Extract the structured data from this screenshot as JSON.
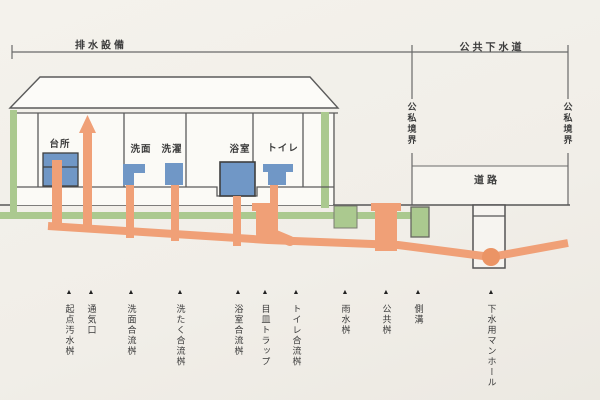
{
  "header": {
    "left_bracket": "排水設備",
    "right_bracket": "公共下水道"
  },
  "boundary_left_label": "公私境界",
  "boundary_right_label": "公私境界",
  "road_label": "道路",
  "rooms": {
    "kitchen": "台所",
    "washbasin": "洗面",
    "laundry": "洗濯",
    "bathroom": "浴室",
    "toilet": "トイレ"
  },
  "marker_glyph": "▲",
  "markers": [
    {
      "label": "起点汚水桝"
    },
    {
      "label": "通気口"
    },
    {
      "label": "洗面合流桝"
    },
    {
      "label": "洗たく合流桝"
    },
    {
      "label": "浴室合流桝"
    },
    {
      "label": "目皿トラップ"
    },
    {
      "label": "トイレ合流桝"
    },
    {
      "label": "雨水桝"
    },
    {
      "label": "公共桝"
    },
    {
      "label": "側溝"
    },
    {
      "label": "下水用マンホール"
    }
  ],
  "colors": {
    "pipe_orange": "#F0A077",
    "junction_orange": "#EB9465",
    "rain_green": "#ABC98F",
    "fixture_blue": "#7097C6",
    "line_gray": "#5b5b5b"
  }
}
